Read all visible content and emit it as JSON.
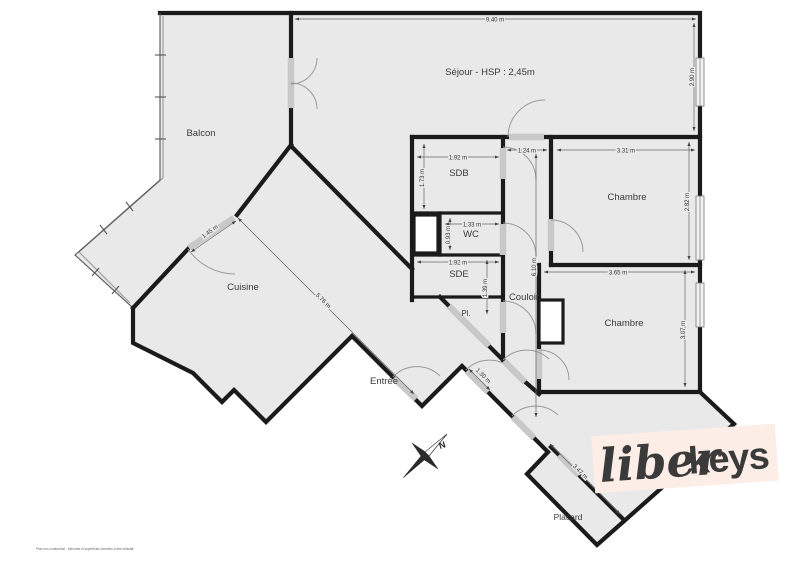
{
  "colors": {
    "wall": "#1b1b1b",
    "room_fill": "#e9e9e9",
    "door_window": "#c8c8c8",
    "logo_bg": "#fceee7",
    "logo_text": "#241d1a"
  },
  "rooms": {
    "sejour": "Séjour - HSP : 2,45m",
    "balcon": "Balcon",
    "cuisine": "Cuisine",
    "entree": "Entrée",
    "sdb": "SDB",
    "wc": "WC",
    "sde": "SDE",
    "pl": "Pl.",
    "couloir": "Couloir",
    "chambre1": "Chambre",
    "chambre2": "Chambre",
    "placard": "Placard"
  },
  "dimensions": {
    "sejour_w": "9.40 m",
    "sejour_h": "2.90 m",
    "sdb_w": "1.92 m",
    "sdb_h": "1.73 m",
    "couloir_w": "1.24 m",
    "chambre1_w": "3.31 m",
    "chambre1_h": "2.82 m",
    "wc_w": "1.33 m",
    "wc_h": "0.93 m",
    "sde_w": "1.92 m",
    "sde_h": "1.39 m",
    "couloir_h": "6.10 m",
    "chambre2_w": "3.65 m",
    "chambre2_h": "3.07 m",
    "balcony_door": "1.45 m",
    "cuisine_diag": "5.76 m",
    "entree_door": "1.30 m",
    "placard_diag": "3.47 m"
  },
  "compass": {
    "north": "N"
  },
  "branding": {
    "logo_script": "liber",
    "logo_bold": "keys",
    "disclaimer": "Plan non contractuel - Mesures et superficies données à titre indicatif"
  }
}
